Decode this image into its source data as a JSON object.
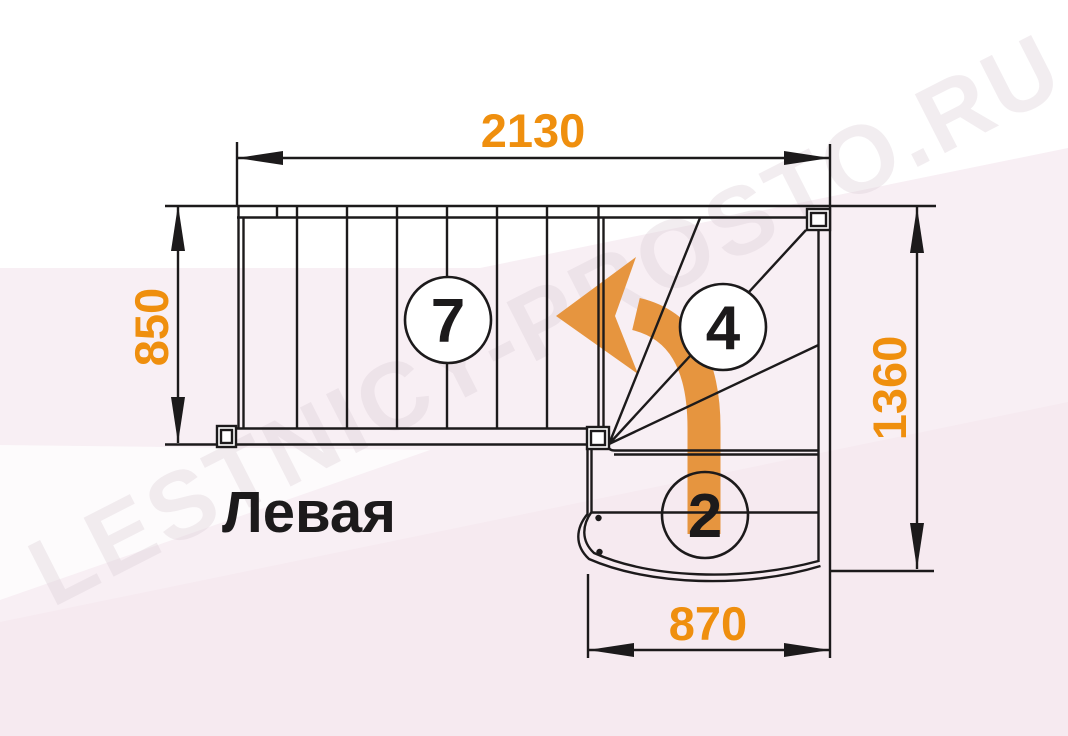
{
  "drawing": {
    "title_label": "Левая",
    "watermark_text": "LESTNICY-PROSTO.RU",
    "dimensions": {
      "top_width_mm": "2130",
      "left_depth_mm": "850",
      "right_height_mm": "1360",
      "bottom_width_mm": "870"
    },
    "step_counts": {
      "upper_straight_flight": "7",
      "winder_steps": "4",
      "lower_flight": "2"
    },
    "colors": {
      "dimension_text_orange": "#EF8F0E",
      "direction_arrow_orange": "#E6953F",
      "linework_black": "#1C1A1B",
      "background_tint_pink": "#F8EFF4",
      "watermark_pink": "#D9CBD4"
    }
  }
}
